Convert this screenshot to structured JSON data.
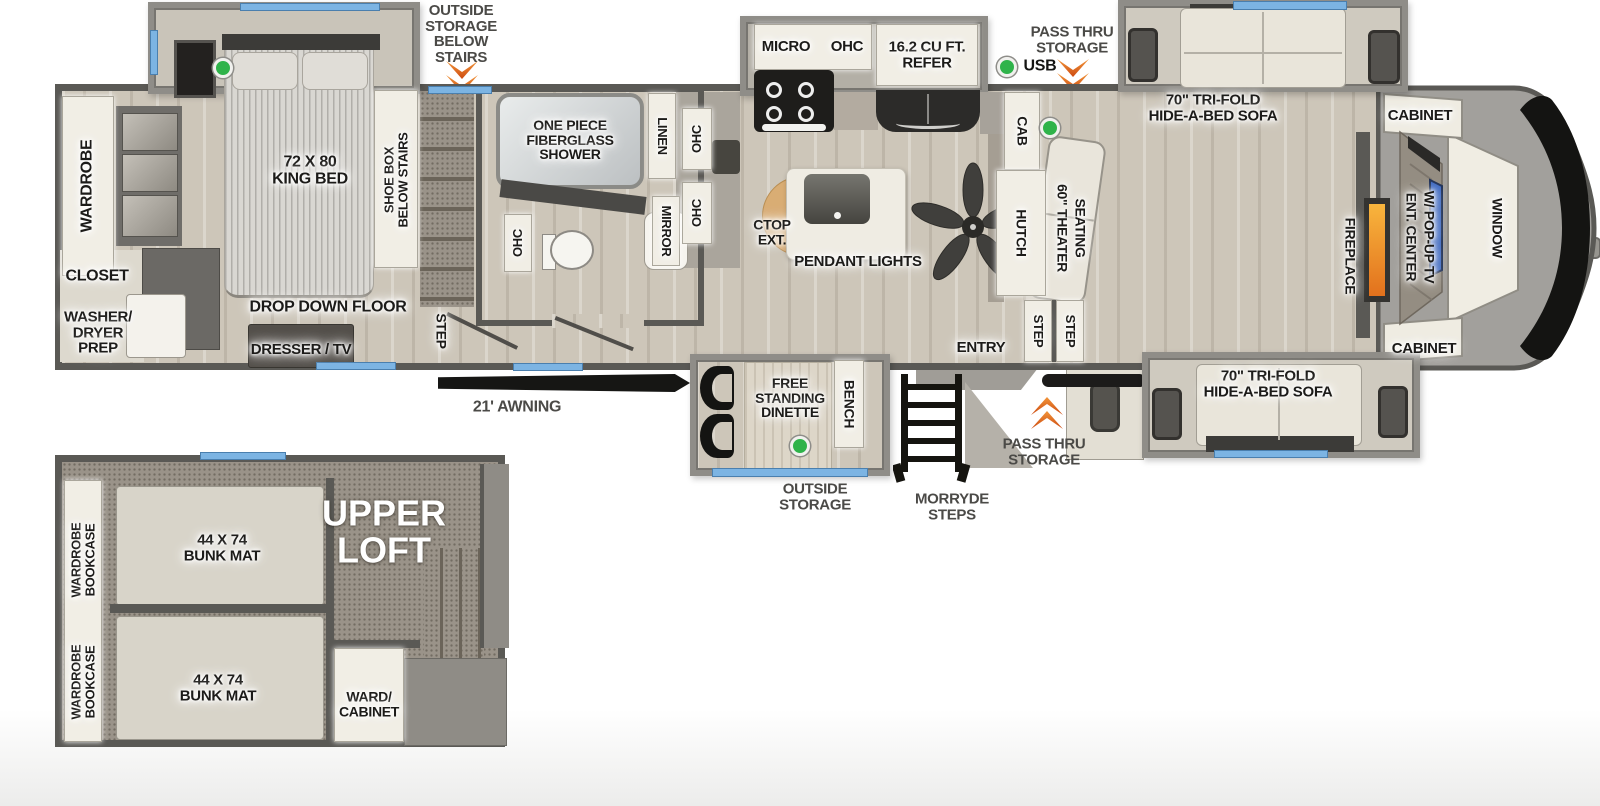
{
  "colors": {
    "accent_orange": "#e2691a",
    "accent_green": "#2fb34a",
    "window_blue": "#7cb4e3",
    "tv_blue": "#3b67c1",
    "fireplace_orange": "#f2a032",
    "wall_gray": "#5a5955"
  },
  "exterior": {
    "outside_storage_below_stairs": "OUTSIDE\nSTORAGE\nBELOW\nSTAIRS",
    "pass_thru_top": "PASS THRU\nSTORAGE",
    "usb": "USB",
    "awning": "21' AWNING",
    "outside_storage_bottom": "OUTSIDE\nSTORAGE",
    "morryde_steps": "MORRYDE\nSTEPS",
    "pass_thru_bottom": "PASS THRU\nSTORAGE"
  },
  "bedroom": {
    "wardrobe": "WARDROBE",
    "closet": "CLOSET",
    "washer_dryer_prep": "WASHER/\nDRYER\nPREP",
    "king_bed": "72 X 80\nKING BED",
    "shoe_box_below_stairs": "SHOE BOX\nBELOW STAIRS",
    "drop_down_floor": "DROP DOWN FLOOR",
    "dresser_tv": "DRESSER / TV",
    "step": "STEP"
  },
  "bathroom": {
    "shower": "ONE PIECE\nFIBERGLASS\nSHOWER",
    "ohc": "OHC",
    "linen": "LINEN",
    "mirror": "MIRROR"
  },
  "kitchen": {
    "micro": "MICRO",
    "ohc_upper": "OHC",
    "refer": "16.2 CU FT.\nREFER",
    "ohc_cab_1": "OHC",
    "ohc_cab_2": "OHC",
    "ctop_ext": "CTOP\nEXT.",
    "pendant_lights": "PENDANT LIGHTS"
  },
  "living": {
    "cab": "CAB",
    "hutch": "HUTCH",
    "theater_1": "60\" THEATER",
    "theater_2": "SEATING",
    "step_1": "STEP",
    "step_2": "STEP",
    "entry": "ENTRY",
    "bench": "BENCH",
    "dinette": "FREE\nSTANDING\nDINETTE",
    "sofa_top": "70\" TRI-FOLD\nHIDE-A-BED SOFA",
    "sofa_bottom": "70\" TRI-FOLD\nHIDE-A-BED SOFA",
    "cabinet_top": "CABINET",
    "cabinet_bottom": "CABINET",
    "fireplace": "FIREPLACE",
    "ent_center_1": "ENT. CENTER",
    "ent_center_2": "W/ POP-UP TV",
    "window": "WINDOW"
  },
  "loft": {
    "title": "UPPER\nLOFT",
    "bunk_mat_top": "44 X 74\nBUNK MAT",
    "bunk_mat_bottom": "44 X 74\nBUNK MAT",
    "wardrobe_bookcase_top": "WARDROBE\nBOOKCASE",
    "wardrobe_bookcase_bottom": "WARDROBE\nBOOKCASE",
    "ward_cabinet": "WARD/\nCABINET"
  }
}
